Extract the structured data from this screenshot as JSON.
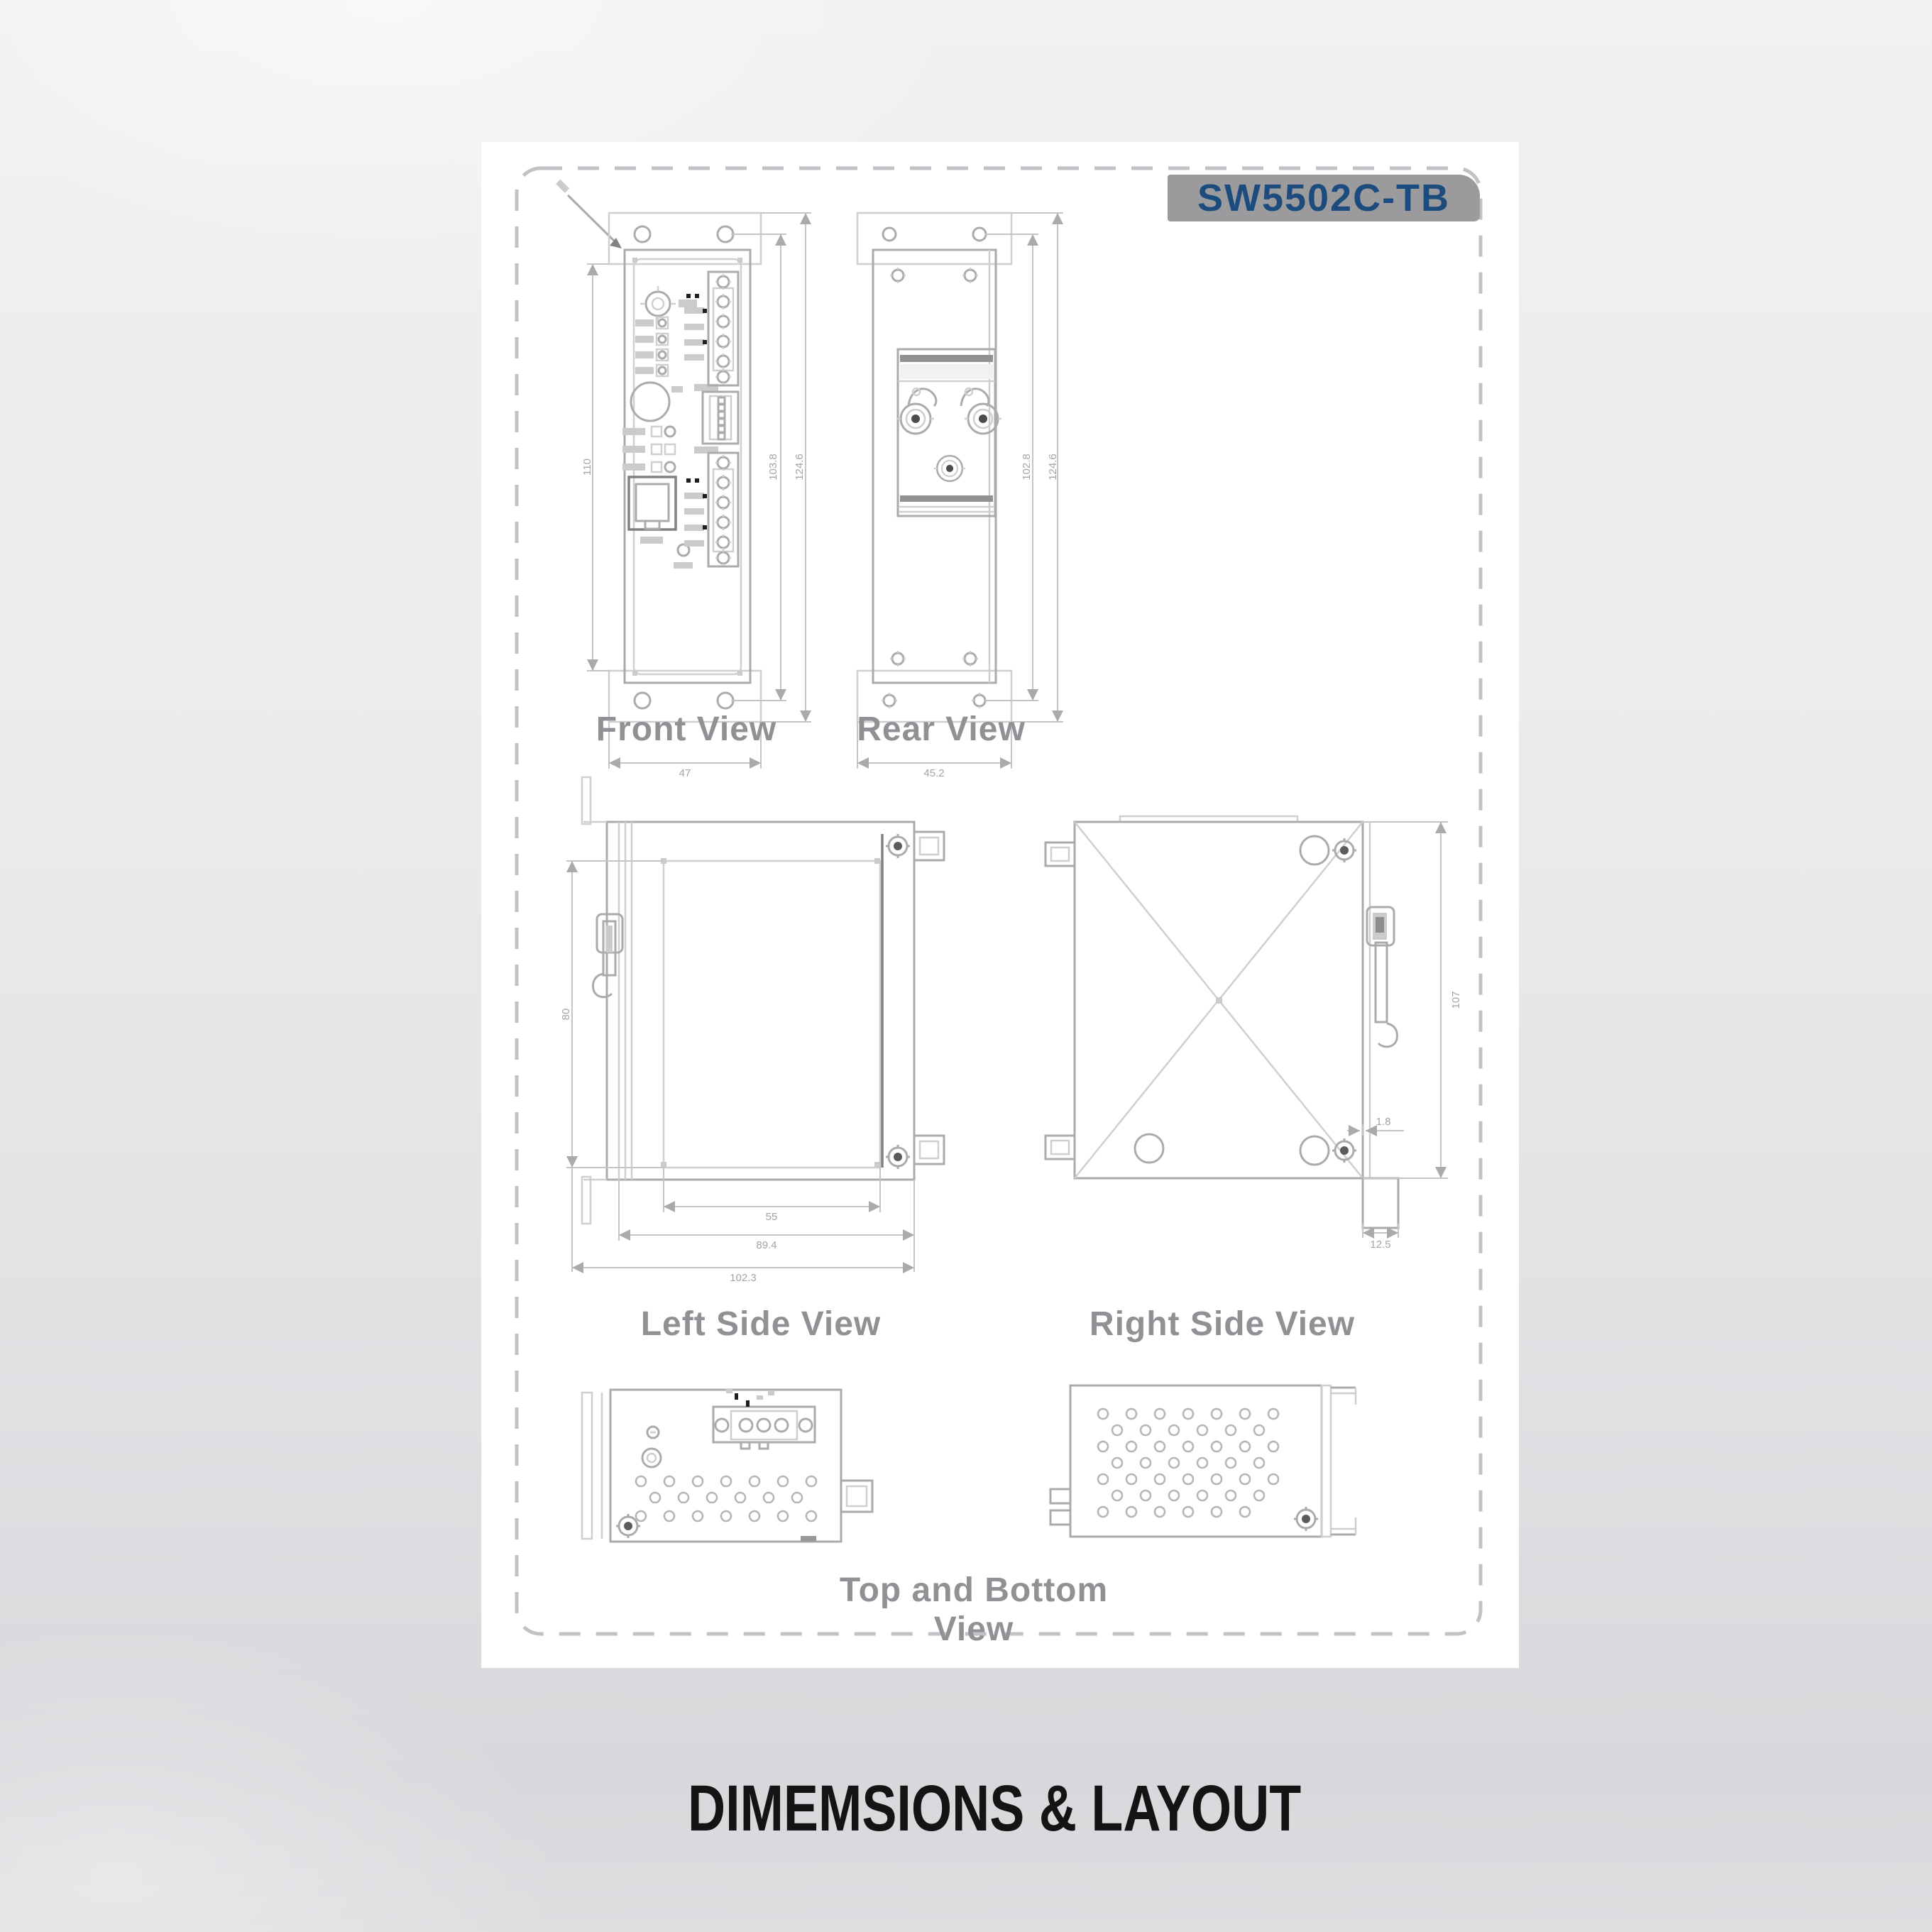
{
  "product": {
    "model_badge": "SW5502C-TB"
  },
  "views": {
    "front": {
      "label": "Front View",
      "dims": {
        "body_height": "110",
        "hole_pitch": "103.8",
        "overall_height": "124.6",
        "width": "47"
      }
    },
    "rear": {
      "label": "Rear View",
      "dims": {
        "hole_pitch": "102.8",
        "overall_height": "124.6",
        "width": "45.2"
      }
    },
    "left_side": {
      "label": "Left Side View",
      "dims": {
        "panel_height": "80",
        "panel_depth": "55",
        "body_depth": "89.4",
        "overall_depth": "102.3"
      }
    },
    "right_side": {
      "label": "Right Side View",
      "dims": {
        "overall_height": "107",
        "clip_inset": "1.8",
        "clip_depth": "12.5"
      }
    },
    "top_bottom": {
      "label": "Top and Bottom View"
    }
  },
  "footer": {
    "title": "DIMEMSIONS & LAYOUT"
  },
  "colors": {
    "badge_bg": "#9b9b9d",
    "badge_text": "#1c4b7d",
    "drawing_line": "#a9abad",
    "view_label": "#8f9194",
    "footer_title": "#141414",
    "page_bg": "#ffffff"
  }
}
